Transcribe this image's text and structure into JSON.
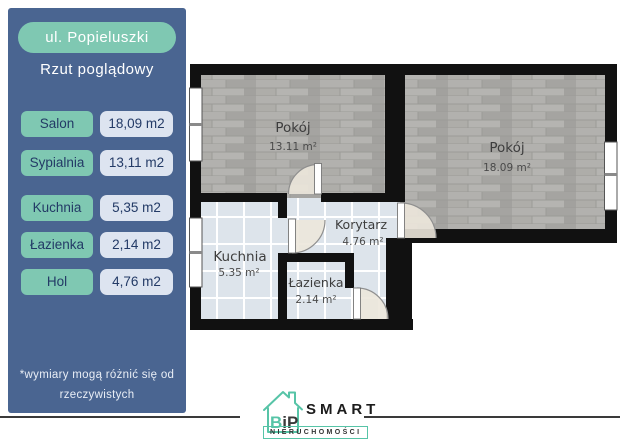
{
  "sidebar": {
    "header": "ul. Popieluszki",
    "subtitle": "Rzut poglądowy",
    "rooms": [
      {
        "label": "Salon",
        "area": "18,09 m2"
      },
      {
        "label": "Sypialnia",
        "area": "13,11 m2"
      },
      {
        "label": "Kuchnia",
        "area": "5,35 m2"
      },
      {
        "label": "Łazienka",
        "area": "2,14 m2"
      },
      {
        "label": "Hol",
        "area": "4,76 m2"
      }
    ],
    "footnote": {
      "line1": "*wymiary mogą różnić się od",
      "line2": "rzeczywistych"
    }
  },
  "floorplan": {
    "rooms": {
      "pokoj_left": {
        "name": "Pokój",
        "area": "13.11 m²"
      },
      "pokoj_right": {
        "name": "Pokój",
        "area": "18.09 m²"
      },
      "kuchnia": {
        "name": "Kuchnia",
        "area": "5.35 m²"
      },
      "korytarz": {
        "name": "Korytarz",
        "area": "4.76 m²"
      },
      "lazienka": {
        "name": "Łazienka",
        "area": "2.14 m²"
      }
    }
  },
  "footer": {
    "logo": {
      "bip": "BiP",
      "smart": "SMART",
      "sub": "NIERUCHOMOŚCI"
    }
  },
  "colors": {
    "sidebar_panel": "#4a6591",
    "accent_teal": "#7fc8b2",
    "value_box": "#dde4f0",
    "text_navy": "#233a66",
    "wall_black": "#111111",
    "tile_floor": "#dde4eb",
    "plank_floor": "#ababa8",
    "logo_teal": "#57c4a7"
  }
}
